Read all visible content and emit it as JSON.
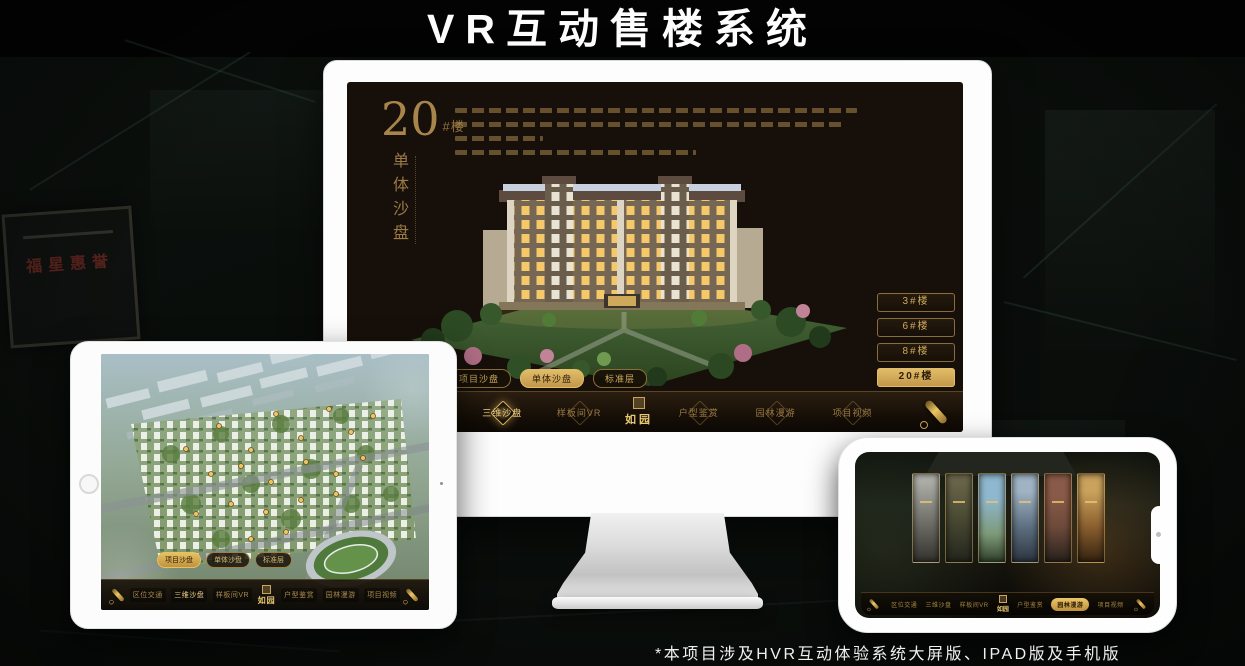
{
  "title": "VR互动售楼系统",
  "footnote": "*本项目涉及HVR互动体验系统大屏版、IPAD版及手机版",
  "background": {
    "plaque_text": "福星惠誉"
  },
  "app": {
    "heading": {
      "number": "20",
      "suffix": "#楼",
      "subtitle": "单体沙盘"
    },
    "floor_tabs": [
      "项目沙盘",
      "单体沙盘",
      "标准层"
    ],
    "building_buttons": [
      "3#楼",
      "6#楼",
      "8#楼",
      "20#楼"
    ],
    "nav_items": [
      "区位交通",
      "三维沙盘",
      "样板间VR",
      "户型鉴赏",
      "园林漫游",
      "项目视频"
    ],
    "logo": "如园"
  },
  "colors": {
    "gold": "#c9a257",
    "screen_bg": "#17100a",
    "title_text": "#fdfdfd"
  }
}
